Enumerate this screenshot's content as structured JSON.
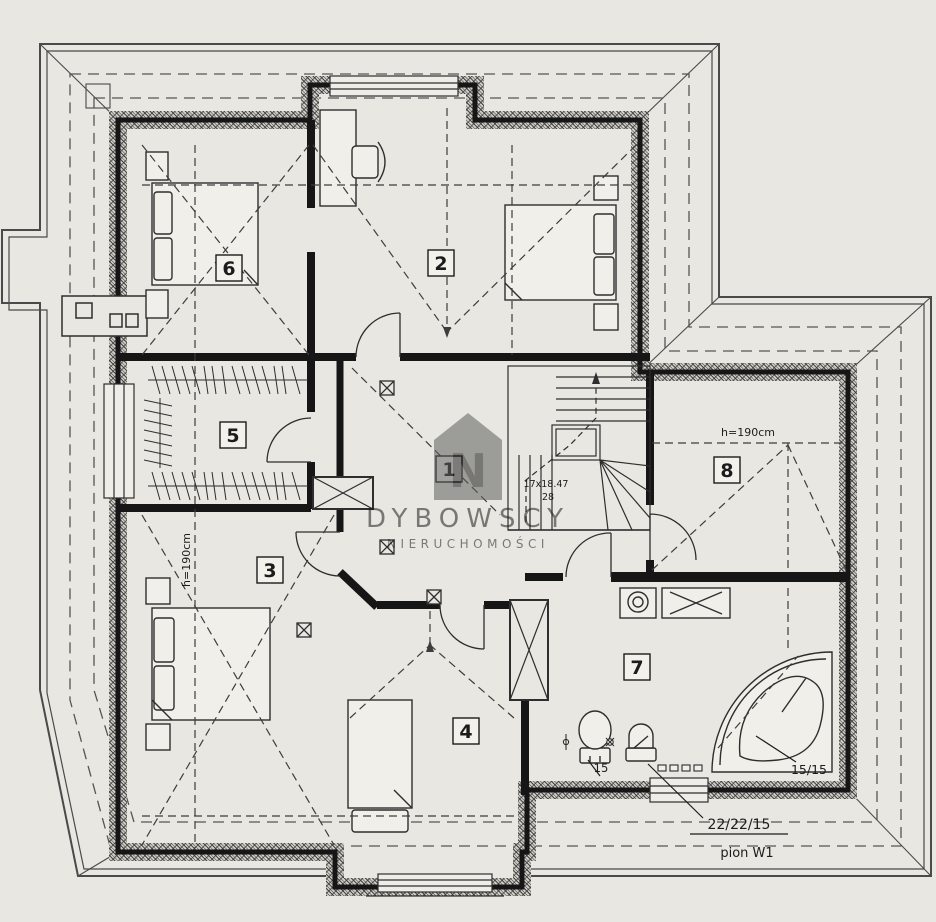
{
  "title": "attic-floor-plan",
  "watermark": {
    "brand": "DYBOWSCY",
    "sub": "NIERUCHOMOŚCI",
    "logo_letter": "N"
  },
  "rooms": [
    {
      "label": "1"
    },
    {
      "label": "2"
    },
    {
      "label": "3"
    },
    {
      "label": "4"
    },
    {
      "label": "5"
    },
    {
      "label": "6"
    },
    {
      "label": "7"
    },
    {
      "label": "8"
    }
  ],
  "annotations": {
    "knee_left": "h=190cm",
    "knee_right": "h=190cm",
    "stairs_line1": "17x18.47",
    "stairs_line2": "28",
    "dim_15": "15",
    "dim_15_15": "15/15",
    "dim_22_22_15": "22/22/15",
    "pion": "pion W1"
  },
  "colors": {
    "paper": "#e9e7e2",
    "wall": "#161616",
    "line": "#2e2e2e",
    "roof": "#4a4a4a",
    "watermark": "#6f6f6f"
  }
}
